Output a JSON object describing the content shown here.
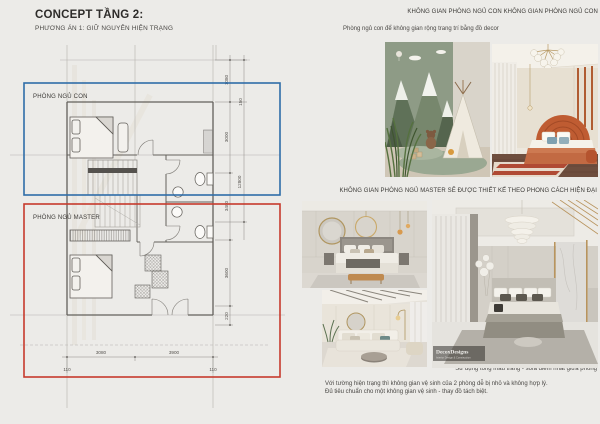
{
  "page": {
    "title": "CONCEPT TẦNG 2:",
    "subtitle": "PHƯƠNG ÁN 1: GIỮ NGUYÊN HIỆN TRẠNG"
  },
  "child_section": {
    "header": "KHÔNG GIAN PHÒNG NGỦ CON KHÔNG GIAN PHÒNG NGỦ CON",
    "caption": "Phòng ngủ con để không gian rộng trang trí  bằng đồ decor",
    "photos": [
      "kids-room-mountain-mural-teepee",
      "kids-room-orange-arch-headboard-bed"
    ]
  },
  "master_section": {
    "header": "KHÔNG GIAN PHÒNG NGỦ MASTER SẼ ĐƯỢC THIẾT KẾ THEO PHONG CÁCH HIỆN ĐẠI",
    "caption": "Sử dụng tông màu trắng - sofa điểm nhất giữa phòng",
    "watermark": "DecoxDesigns",
    "watermark_sub": "Interior Design & Construction",
    "photos": [
      "master-bedroom-round-mirror",
      "master-living-white-sofa",
      "master-bedroom-large-modern"
    ]
  },
  "notes": {
    "line1": "Với tường hiện trạng thì không gian vệ sinh của 2 phòng dễ bị nhỏ và không hợp lý.",
    "line2": "Đủ tiêu chuẩn cho một không gian vệ sinh - thay đồ tách biệt."
  },
  "floor_plan": {
    "child_label": "PHÒNG NGỦ CON",
    "master_label": "PHÒNG NGỦ MASTER",
    "vdims": [
      "1080",
      "150",
      "3000",
      "12800",
      "3400",
      "3600",
      "220"
    ],
    "hdims": [
      "3080",
      "3900"
    ],
    "edge_dims": [
      "110",
      "110"
    ],
    "colors": {
      "child_box": "#2f6da8",
      "master_box": "#c63a2c",
      "background": "#ecebe8"
    }
  }
}
